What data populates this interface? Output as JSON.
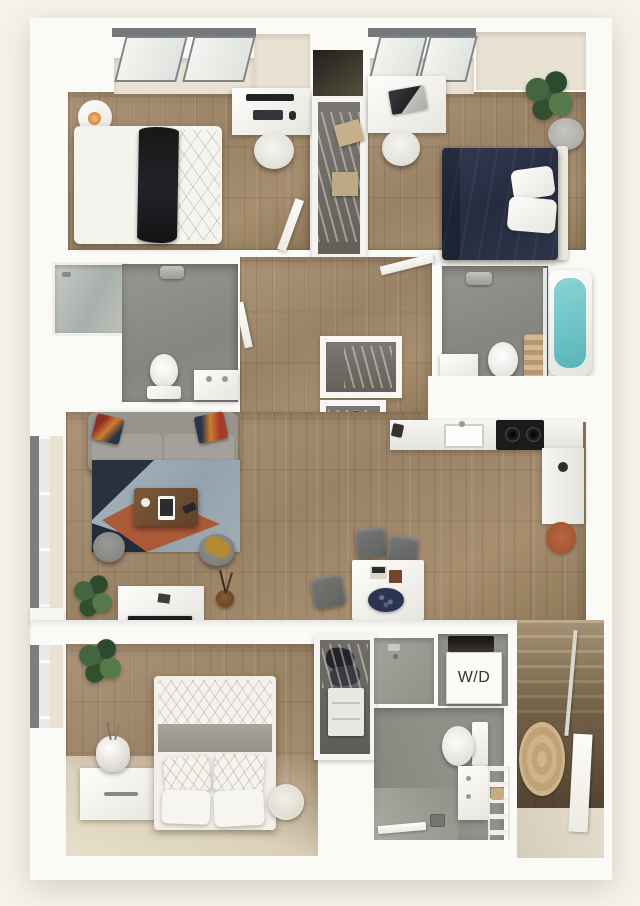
{
  "plan": {
    "type": "apartment-floor-plan-3d",
    "labels": {
      "washer_dryer": "W/D"
    },
    "palette": {
      "background": "#f6f2ea",
      "wall": "#fbfaf6",
      "wood_floor": "#a28b6d",
      "wood_dark": "#8f7858",
      "bathroom_floor": "#8e8e87",
      "closet_floor": "#73716b",
      "shower_glass": "#b7bcb9",
      "rug_blue": "#9fadb6",
      "rug_navy": "#28313f",
      "rug_rust": "#ab5a37",
      "sofa_gray": "#96948d",
      "bed_navy": "#2b3147",
      "tub_teal": "#6cc5c7",
      "plant_green": "#3f5f3a",
      "jute_rug": "#c8ae86",
      "stair_wood": "#9b8667",
      "entry_floor": "#dcd5c5",
      "coffee_table_wood": "#6b4a33",
      "label_text": "#333333"
    },
    "rooms": [
      {
        "name": "bedroom-top-left",
        "furniture": [
          "window-bay",
          "bed",
          "black-throw-blanket",
          "round-nightstand",
          "lamp",
          "desk",
          "monitor",
          "keyboard",
          "desk-chair"
        ]
      },
      {
        "name": "bedroom-top-right",
        "furniture": [
          "window-bay",
          "navy-bed",
          "white-pillows",
          "headboard",
          "desk",
          "laptop",
          "desk-chair",
          "plant",
          "round-side-table"
        ]
      },
      {
        "name": "closet-top-center",
        "furniture": [
          "hanging-clothes",
          "folded-linens"
        ]
      },
      {
        "name": "bathroom-left",
        "furniture": [
          "glass-shower",
          "toilet",
          "vanity-sink",
          "ceiling-light"
        ]
      },
      {
        "name": "bathroom-right",
        "furniture": [
          "teal-bathtub",
          "glass-screen",
          "toilet",
          "vanity-sink",
          "rolled-towels",
          "ceiling-light"
        ]
      },
      {
        "name": "hallway",
        "furniture": [
          "linen-closet-upper",
          "linen-closet-lower",
          "open-doors"
        ]
      },
      {
        "name": "living-room",
        "furniture": [
          "sofa",
          "accent-pillows",
          "area-rug",
          "coffee-table",
          "ottoman",
          "ottoman",
          "tv-console",
          "tv",
          "plant",
          "window-wall"
        ]
      },
      {
        "name": "kitchen",
        "furniture": [
          "counter",
          "sink",
          "cooktop",
          "side-counter",
          "round-rust-rug"
        ]
      },
      {
        "name": "dining-area",
        "furniture": [
          "white-table",
          "serving-platter",
          "chair",
          "chair",
          "chair"
        ]
      },
      {
        "name": "bedroom-bottom",
        "furniture": [
          "bed",
          "patterned-duvet",
          "pillows",
          "dresser",
          "vase-lamp",
          "plant",
          "round-pouf"
        ]
      },
      {
        "name": "closet-bottom",
        "furniture": [
          "hanging-clothes",
          "drawer-unit"
        ]
      },
      {
        "name": "laundry-closet",
        "furniture": [
          "washer-dryer"
        ]
      },
      {
        "name": "bathroom-bottom",
        "furniture": [
          "walk-in-shower",
          "toilet",
          "vanity-sink",
          "towel-ladder",
          "floor-drain"
        ]
      },
      {
        "name": "entry",
        "furniture": [
          "staircase",
          "handrail",
          "jute-rug",
          "entry-door"
        ]
      }
    ]
  }
}
